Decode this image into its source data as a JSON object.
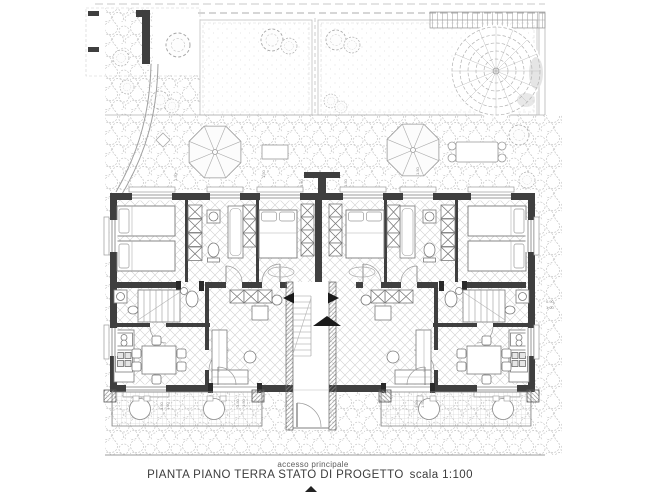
{
  "page": {
    "background": "#ffffff"
  },
  "plan": {
    "caption": "accesso principale",
    "title": "PIANTA PIANO TERRA STATO DI PROGETTO",
    "scale": "scala 1:100",
    "colors": {
      "wall": "#3f3f3f",
      "furniture_line": "#7a7a7a",
      "texture_line": "#b5b5b5",
      "hatch_line": "#8a8a8a",
      "title_text": "#3c3c3c",
      "caption_text": "#5a5a5a",
      "arrow": "#1a1a1a"
    },
    "dims": [
      "3.50",
      "1.50",
      "3.50",
      "1.50",
      "0.90",
      "1.00",
      "1.50",
      "1.50",
      "1.50",
      "1.50",
      "1.50",
      "3.50",
      "1.50"
    ]
  }
}
